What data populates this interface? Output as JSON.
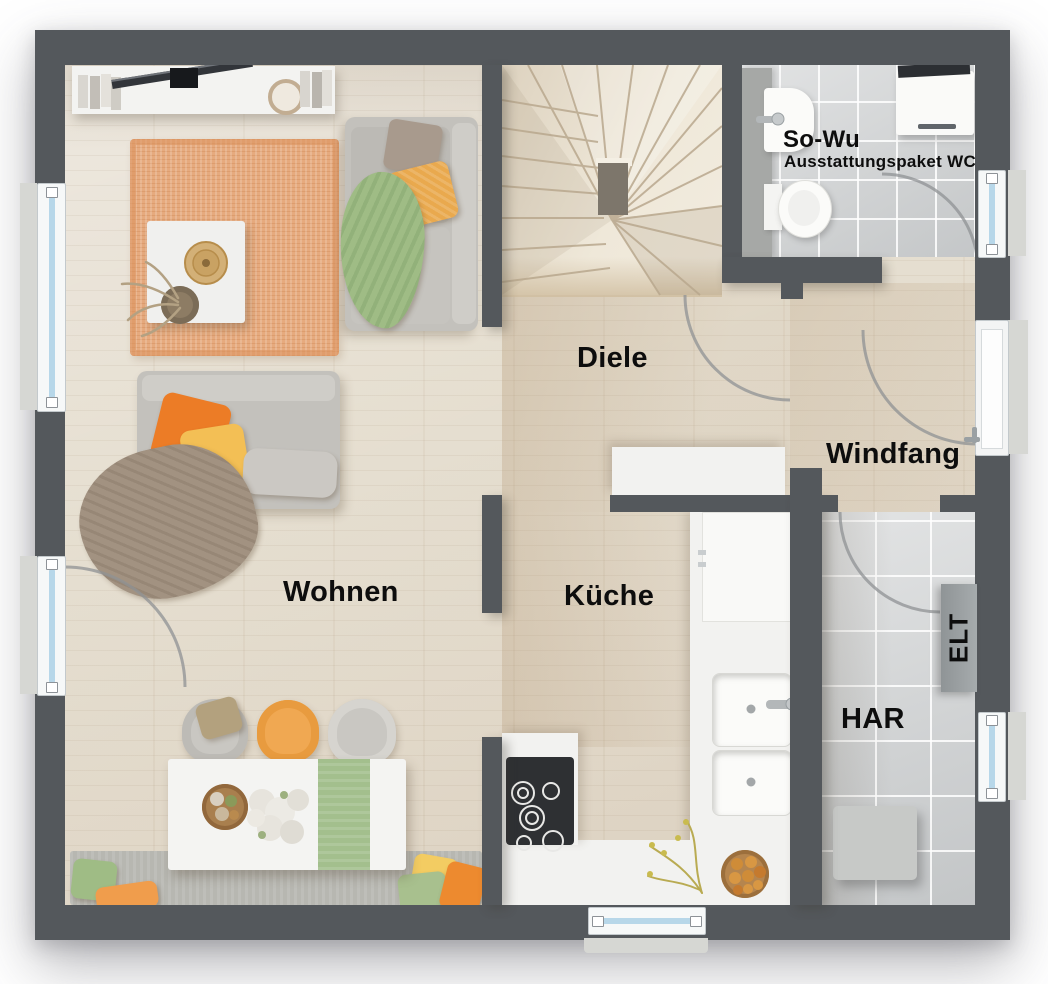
{
  "rooms": {
    "wohnen": {
      "label": "Wohnen"
    },
    "kueche": {
      "label": "Küche"
    },
    "diele": {
      "label": "Diele"
    },
    "windfang": {
      "label": "Windfang"
    },
    "har": {
      "label": "HAR"
    },
    "wc": {
      "label": "So-Wu",
      "sublabel": "Ausstattungspaket WC"
    },
    "elt": {
      "label": "ELT"
    }
  },
  "colors": {
    "wall": "#54585c",
    "wood_floor": "#e4dccd",
    "warm_floor": "#d5c2a6",
    "tile_floor": "#d5d7d8",
    "window_glass": "#b7d7e9",
    "window_frame": "#f6f8f8",
    "rug": "#e6aa7e",
    "sofa": "#c3c1bc",
    "accent_orange": "#ec7c26",
    "accent_yellow": "#f3bf55",
    "accent_green": "#9fbc85",
    "blanket_taupe": "#a29281",
    "counter_white": "#f2f2f0",
    "cooktop": "#2e3033",
    "bench": "#b7b7b1",
    "appliance": "#c7c9c7",
    "elt_panel": "#9aa0a2"
  }
}
